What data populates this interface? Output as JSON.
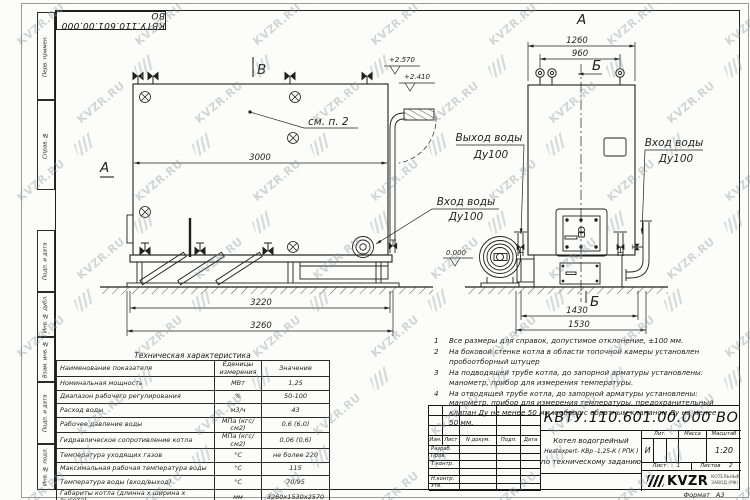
{
  "colors": {
    "line": "#1f1f1f",
    "paper": "#fcfcfa",
    "watermark": "#8f98a1"
  },
  "watermark": {
    "text": "KVZR.RU"
  },
  "stamp_top": "КВТУ.110.601.00.000  ВО",
  "margin": {
    "top": [
      "Перв. примен.",
      "Справ. №"
    ],
    "bottom": [
      "Подп. и дата",
      "Инв. № дубл.",
      "Взам. инв. №",
      "Подп. и дата",
      "Инв. № подл."
    ]
  },
  "views": {
    "side": {
      "view_mark": "В",
      "section_mark": "А",
      "callout": "см. п. 2",
      "dim_width": "3000",
      "dim_base1": "3220",
      "dim_base2": "3260",
      "elev1": "+2.570",
      "elev2": "+2.410",
      "inlet_line1": "Вход воды",
      "inlet_line2": "Ду100"
    },
    "front": {
      "view_mark": "А",
      "section_top": "Б",
      "section_bottom": "Б",
      "dim_top1": "1260",
      "dim_top2": "960",
      "dim_base1": "1430",
      "dim_base2": "1530",
      "elev_zero": "0.000",
      "outlet_line1": "Выход воды",
      "outlet_line2": "Ду100",
      "inlet_line1": "Вход воды",
      "inlet_line2": "Ду100"
    }
  },
  "notes": [
    {
      "num": "1",
      "text": "Все размеры для справок, допустимое отклонение, ±100 мм."
    },
    {
      "num": "2",
      "text": "На боковой стенке котла в области топочной камеры установлен пробоотборный штуцер"
    },
    {
      "num": "3",
      "text": "На  подводящей трубе котла, до запорной арматуры установлены: манометр, прибор для измерения температуры."
    },
    {
      "num": "4",
      "text": "На отводящей трубе котла, до запорной арматуры установлены: манометр, прибор для измерения температуры, предохранительный клапан  Ду не менее 50 мм и обвод с обратным клапаном  Ду не менее 50 мм."
    }
  ],
  "tech_table": {
    "title": "Техническая характеристика",
    "headers": [
      "Наименование показателя",
      "Еденицы измерения",
      "Значение"
    ],
    "rows": [
      [
        "Номинальная мощность",
        "МВт",
        "1,25"
      ],
      [
        "Диапазон рабочего регулирования",
        "%",
        "50-100"
      ],
      [
        "Расход воды",
        "м3/ч",
        "43"
      ],
      [
        "Рабочее давление воды",
        "МПа (кгс/см2)",
        "0,6 (6,0)"
      ],
      [
        "Гидравлическое сопротивление котла",
        "МПа (кгс/см2)",
        "0,06 (0,6)"
      ],
      [
        "Температура уходящих газов",
        "°С",
        "не более 220"
      ],
      [
        "Максимальная рабочая температура воды",
        "°С",
        "115"
      ],
      [
        "Температура воды (вход/выход)",
        "°С",
        "70/95"
      ],
      [
        "Габариты котла (длинна х ширина х высота)",
        "мм",
        "3260х1530х2570"
      ]
    ]
  },
  "title_block": {
    "doc_number": "КВТУ.110.601.00.000  ВО",
    "name_line1": "Котел водогрейный",
    "name_line2": "Heatexpert- КВр -1,25-К ( РПК )",
    "name_line3": "по техническому заданию",
    "col_headers": {
      "izm": "Изм.",
      "list": "Лист",
      "ndoc": "N докум.",
      "podp": "Подп.",
      "data": "Дата"
    },
    "rows": [
      "Разраб.",
      "Пров.",
      "Т.контр.",
      "",
      "Н.контр.",
      "Утв."
    ],
    "lit_header": "Лит.",
    "mass_header": "Масса",
    "scale_header": "Масштаб",
    "lit_value": "И",
    "scale_value": "1:20",
    "sheet_label": "Лист",
    "sheet_value": "1",
    "sheets_label": "Листов",
    "sheets_value": "2",
    "logo": "KVZR",
    "logo_sub1": "КОТЕЛЬНЫЙ",
    "logo_sub2": "ЗАВОД (РФ)",
    "format_label": "Формат",
    "format_value": "А3"
  }
}
